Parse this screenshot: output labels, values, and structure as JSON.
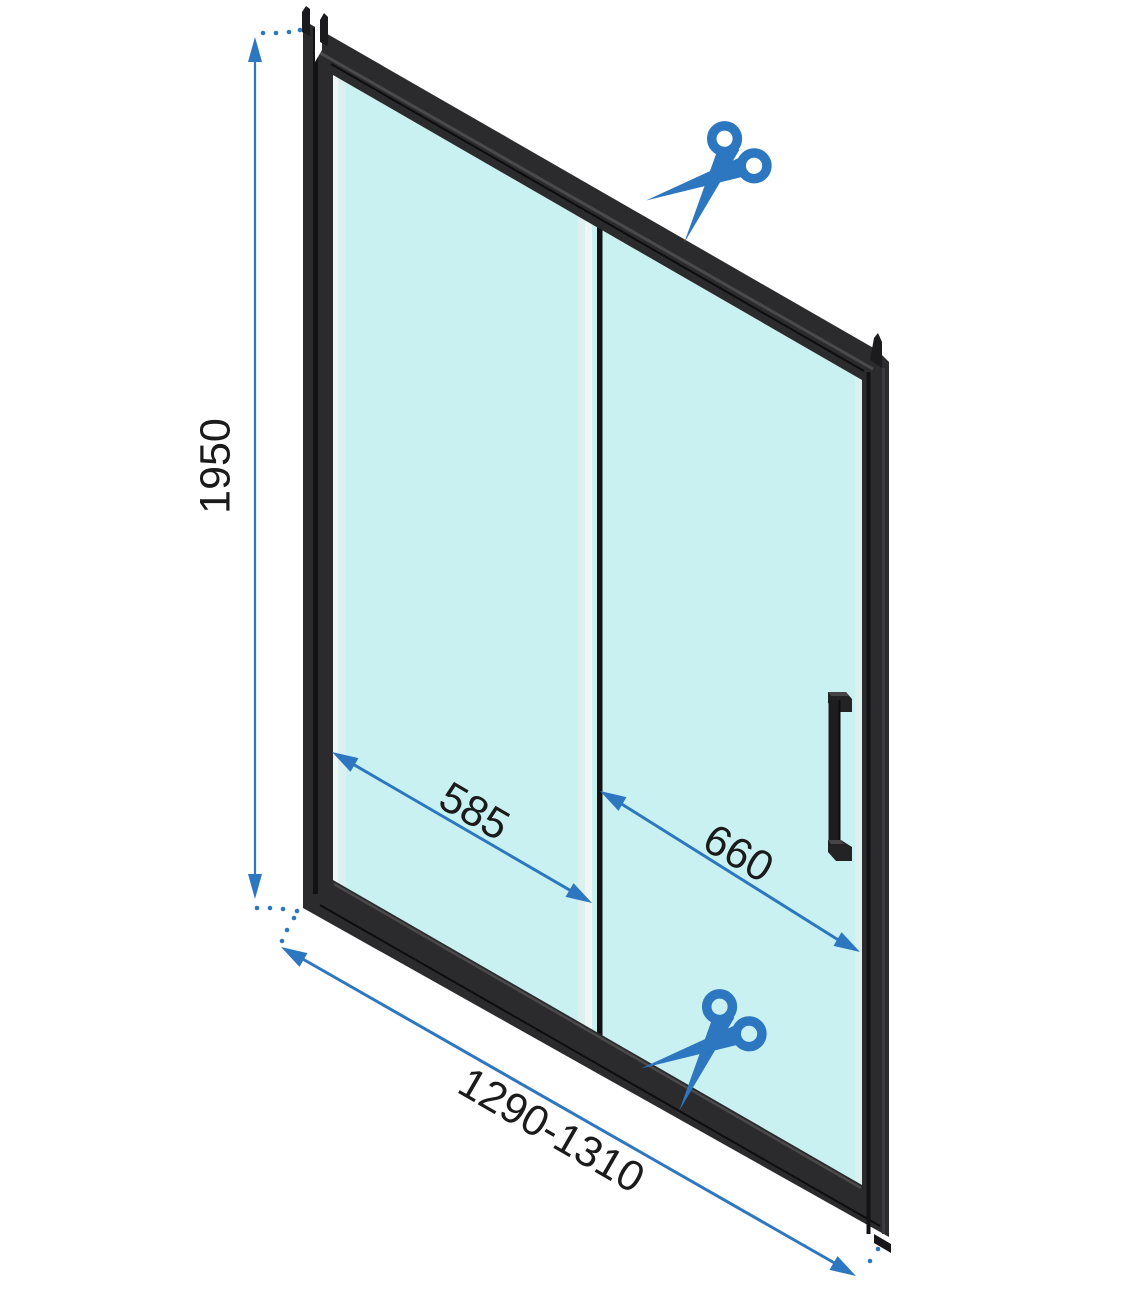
{
  "diagram_type": "shower-door-technical-drawing",
  "dimensions": {
    "height": "1950",
    "left_panel_width": "585",
    "door_panel_width": "660",
    "total_width_range": "1290-1310"
  },
  "icons": {
    "scissors": "✂"
  },
  "colors": {
    "accent": "#2c77c0",
    "glass": "#c9f1f2",
    "glassEdge": "#dcf0ef",
    "glassEdgeLight": "#eef7f6",
    "frame": "#2b2b2d",
    "frameDark": "#121214",
    "frameLight": "#4a4a4c",
    "text": "#1b1b1b",
    "background": "#ffffff"
  }
}
